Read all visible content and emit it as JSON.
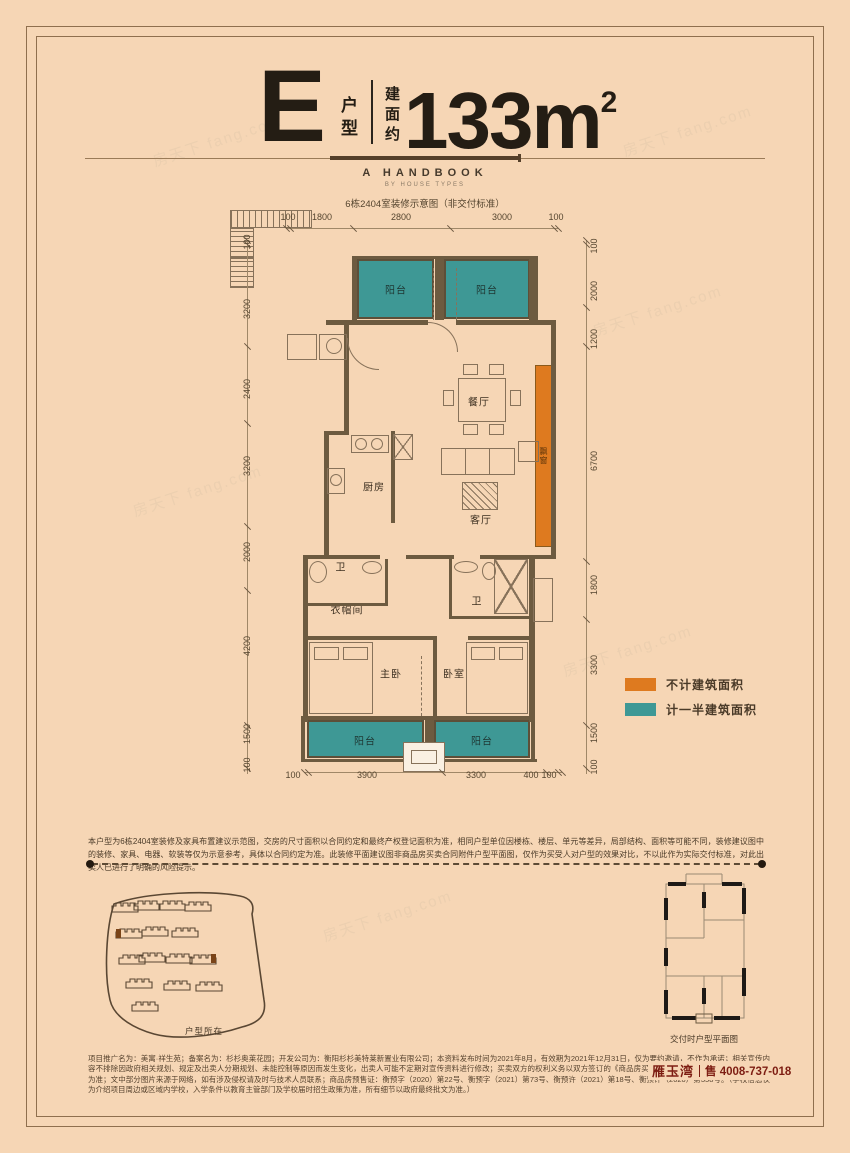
{
  "header": {
    "unit_letter": "E",
    "unit_label_chars": [
      "户",
      "型"
    ],
    "area_prefix_chars": [
      "建",
      "面",
      "约"
    ],
    "area_value": "133m",
    "area_exp": "2",
    "handbook": "A HANDBOOK",
    "handbook_sub": "BY HOUSE TYPES",
    "note": "6栋2404室装修示意图（非交付标准）"
  },
  "plan": {
    "dims": {
      "top": [
        "100",
        "1800",
        "2800",
        "3000",
        "100"
      ],
      "bottom": [
        "100",
        "3900",
        "3300",
        "400",
        "100"
      ],
      "left": [
        "100",
        "3200",
        "2400",
        "3200",
        "2000",
        "4200",
        "1500",
        "100"
      ],
      "right": [
        "100",
        "2000",
        "1200",
        "6700",
        "1800",
        "3300",
        "1500",
        "100"
      ]
    },
    "rooms": {
      "balcony_top_left": "阳台",
      "balcony_top_right": "阳台",
      "dining": "餐厅",
      "kitchen": "厨房",
      "living": "客厅",
      "bath1": "卫",
      "cloakroom": "衣帽间",
      "bath2": "卫",
      "master": "主卧",
      "bedroom": "卧室",
      "balcony_bottom_left": "阳台",
      "balcony_bottom_right": "阳台",
      "bay_window": "飘窗"
    }
  },
  "legend": {
    "items": [
      {
        "color": "#de7a1f",
        "label": "不计建筑面积"
      },
      {
        "color": "#3e9895",
        "label": "计一半建筑面积"
      }
    ]
  },
  "disclaimer": "本户型为6栋2404室装修及家具布置建议示范图，交房的尺寸面积以合同约定和最终产权登记面积为准，相同户型单位因楼栋、楼层、单元等差异，局部结构、面积等可能不同，装修建议图中的装修、家具、电器、软装等仅为示意参考，具体以合同约定为准。此装修平面建议图非商品房买卖合同附件户型平面图，仅作为买受人对户型的效果对比，不以此作为实际交付标准，对此出卖人已进行了明确的风险提示。",
  "sitemap": {
    "label": "户型所在"
  },
  "delivery": {
    "label": "交付时户型平面图"
  },
  "footer": {
    "text": "项目推广名为：美寓·祥生苑；备案名为：杉杉奥莱花园；开发公司为：衡阳杉杉美特莱新置业有限公司；本资料发布时间为2021年8月，有效期为2021年12月31日，仅为要约邀请，不作为承诺；相关宣传内容不排除因政府相关规划、规定及出卖人分期规划、未能控制等原因而发生变化，出卖人可能不定期对宣传资料进行修改；买卖双方的权利义务以双方签订的《商品房买卖合同》及其补充协议、附件等书面为准；文中部分图片来源于网络，如有涉及侵权请及时与技术人员联系；商品房预售证：衡预字（2020）第22号、衡预字（2021）第73号、衡预许（2021）第18号、衡预许（2020）第358号。（学校信息仅为介绍项目周边或区域内学校，入学条件以教育主管部门及学校届时招生政策为准，所有细节以政府最终批文为准。）",
    "brand": "雁玉湾",
    "phone": "售 4008-737-018"
  },
  "watermark": "房天下 fang.com",
  "colors": {
    "background": "#f6d6b5",
    "wall": "#6d5b40",
    "teal": "#3e9895",
    "orange": "#de7a1f",
    "accent_red": "#7d1d12"
  }
}
